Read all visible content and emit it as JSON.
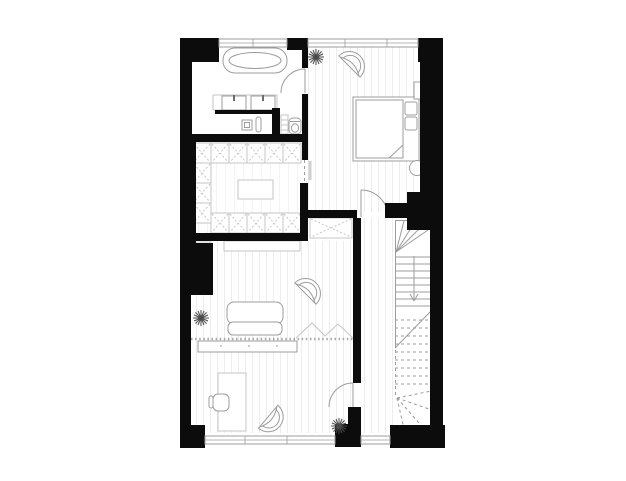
{
  "document": {
    "kind": "architectural-floor-plan",
    "view": "top-down",
    "visible_text": "none"
  },
  "colors": {
    "background": "#ffffff",
    "wall": "#0c0c0c",
    "line": "#9c9c9c",
    "light_line": "#c6c6c6",
    "floor_stripe": "#ededed",
    "closet_stripe": "#f3f3f3",
    "plant": "#4a4a4a"
  },
  "rooms": [
    {
      "id": "bathroom",
      "position": "top-left",
      "fixtures": [
        "bathtub",
        "double-vanity-two-sinks",
        "vanity-counter",
        "floor-drain",
        "radiator",
        "shelf-unit",
        "toilet"
      ]
    },
    {
      "id": "bedroom",
      "position": "top-right",
      "furniture": [
        "double-bed",
        "two-pillows",
        "mattress-fold-corner",
        "bedside-table",
        "round-side-table",
        "shell-armchair",
        "potted-plant"
      ]
    },
    {
      "id": "walk-in-closet",
      "position": "middle-left",
      "furniture": [
        "wardrobe-cell-units-u-shape",
        "center-island"
      ],
      "access": "sliding-pocket-door"
    },
    {
      "id": "living-area",
      "position": "center-bottom",
      "furniture": [
        "sofa",
        "shell-armchair",
        "tv-bench",
        "small-storage-cell",
        "sideboard",
        "folding-glass-partition",
        "potted-plant"
      ]
    },
    {
      "id": "office-area",
      "position": "bottom-left",
      "furniture": [
        "desk",
        "desk-chair",
        "shell-armchair",
        "potted-plant"
      ]
    },
    {
      "id": "stair-hall",
      "position": "right",
      "features": [
        "winder-staircase-down-arrow",
        "cut-break-line",
        "dashed-lower-flight",
        "hall-wardrobe"
      ]
    }
  ],
  "doors": [
    {
      "id": "bathroom-door",
      "type": "swing"
    },
    {
      "id": "bedroom-door",
      "type": "swing"
    },
    {
      "id": "office-door",
      "type": "swing"
    },
    {
      "id": "closet-door",
      "type": "sliding-pocket"
    }
  ],
  "windows": {
    "top_wall": 2,
    "bottom_wall": 2
  }
}
